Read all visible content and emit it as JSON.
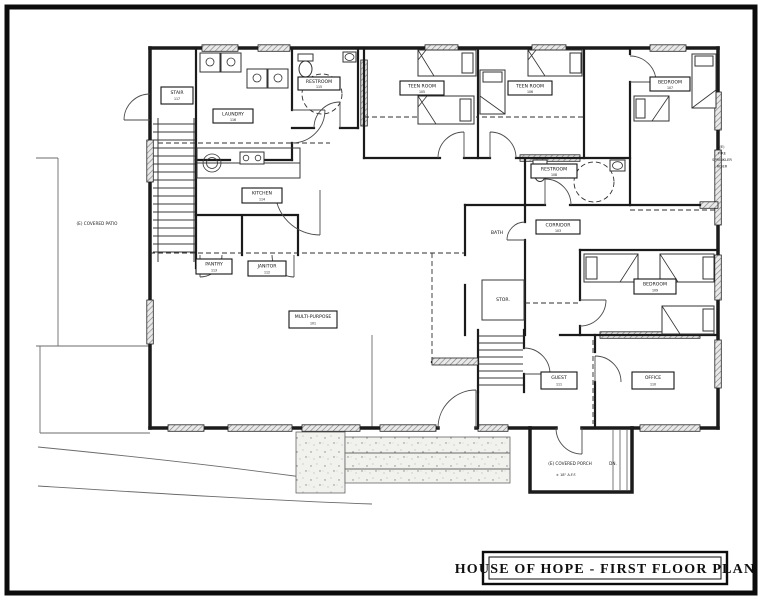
{
  "title_block": {
    "title": "HOUSE OF HOPE - FIRST FLOOR PLAN"
  },
  "rooms": {
    "stair": {
      "label": "STAIR",
      "number": "117"
    },
    "laundry": {
      "label": "LAUNDRY",
      "number": "116"
    },
    "restroom_top": {
      "label": "RESTROOM",
      "number": "115"
    },
    "kitchen": {
      "label": "KITCHEN",
      "number": "114"
    },
    "pantry": {
      "label": "PANTRY",
      "number": "113"
    },
    "janitor": {
      "label": "JANITOR",
      "number": "112"
    },
    "teen_room_1": {
      "label": "TEEN ROOM",
      "number": "105"
    },
    "teen_room_2": {
      "label": "TEEN ROOM",
      "number": "106"
    },
    "bedroom_ne": {
      "label": "BEDROOM",
      "number": "107"
    },
    "restroom_mid": {
      "label": "RESTROOM",
      "number": "108"
    },
    "corridor": {
      "label": "CORRIDOR",
      "number": "103"
    },
    "bath": {
      "label": "BATH"
    },
    "storage": {
      "label": "STOR."
    },
    "multi_purpose": {
      "label": "MULTI-PURPOSE",
      "number": "101"
    },
    "bedroom_e": {
      "label": "BEDROOM",
      "number": "109"
    },
    "guest": {
      "label": "GUEST",
      "number": "111"
    },
    "office": {
      "label": "OFFICE",
      "number": "110"
    }
  },
  "annotations": {
    "covered_patio": "(E) COVERED PATIO",
    "fire_riser": [
      "(E)",
      "FIRE",
      "SPRINKLER",
      "RISER"
    ],
    "covered_porch": "(E) COVERED PORCH",
    "porch_direction": "DN.",
    "porch_elevation": "± 18\" A.F.F."
  }
}
